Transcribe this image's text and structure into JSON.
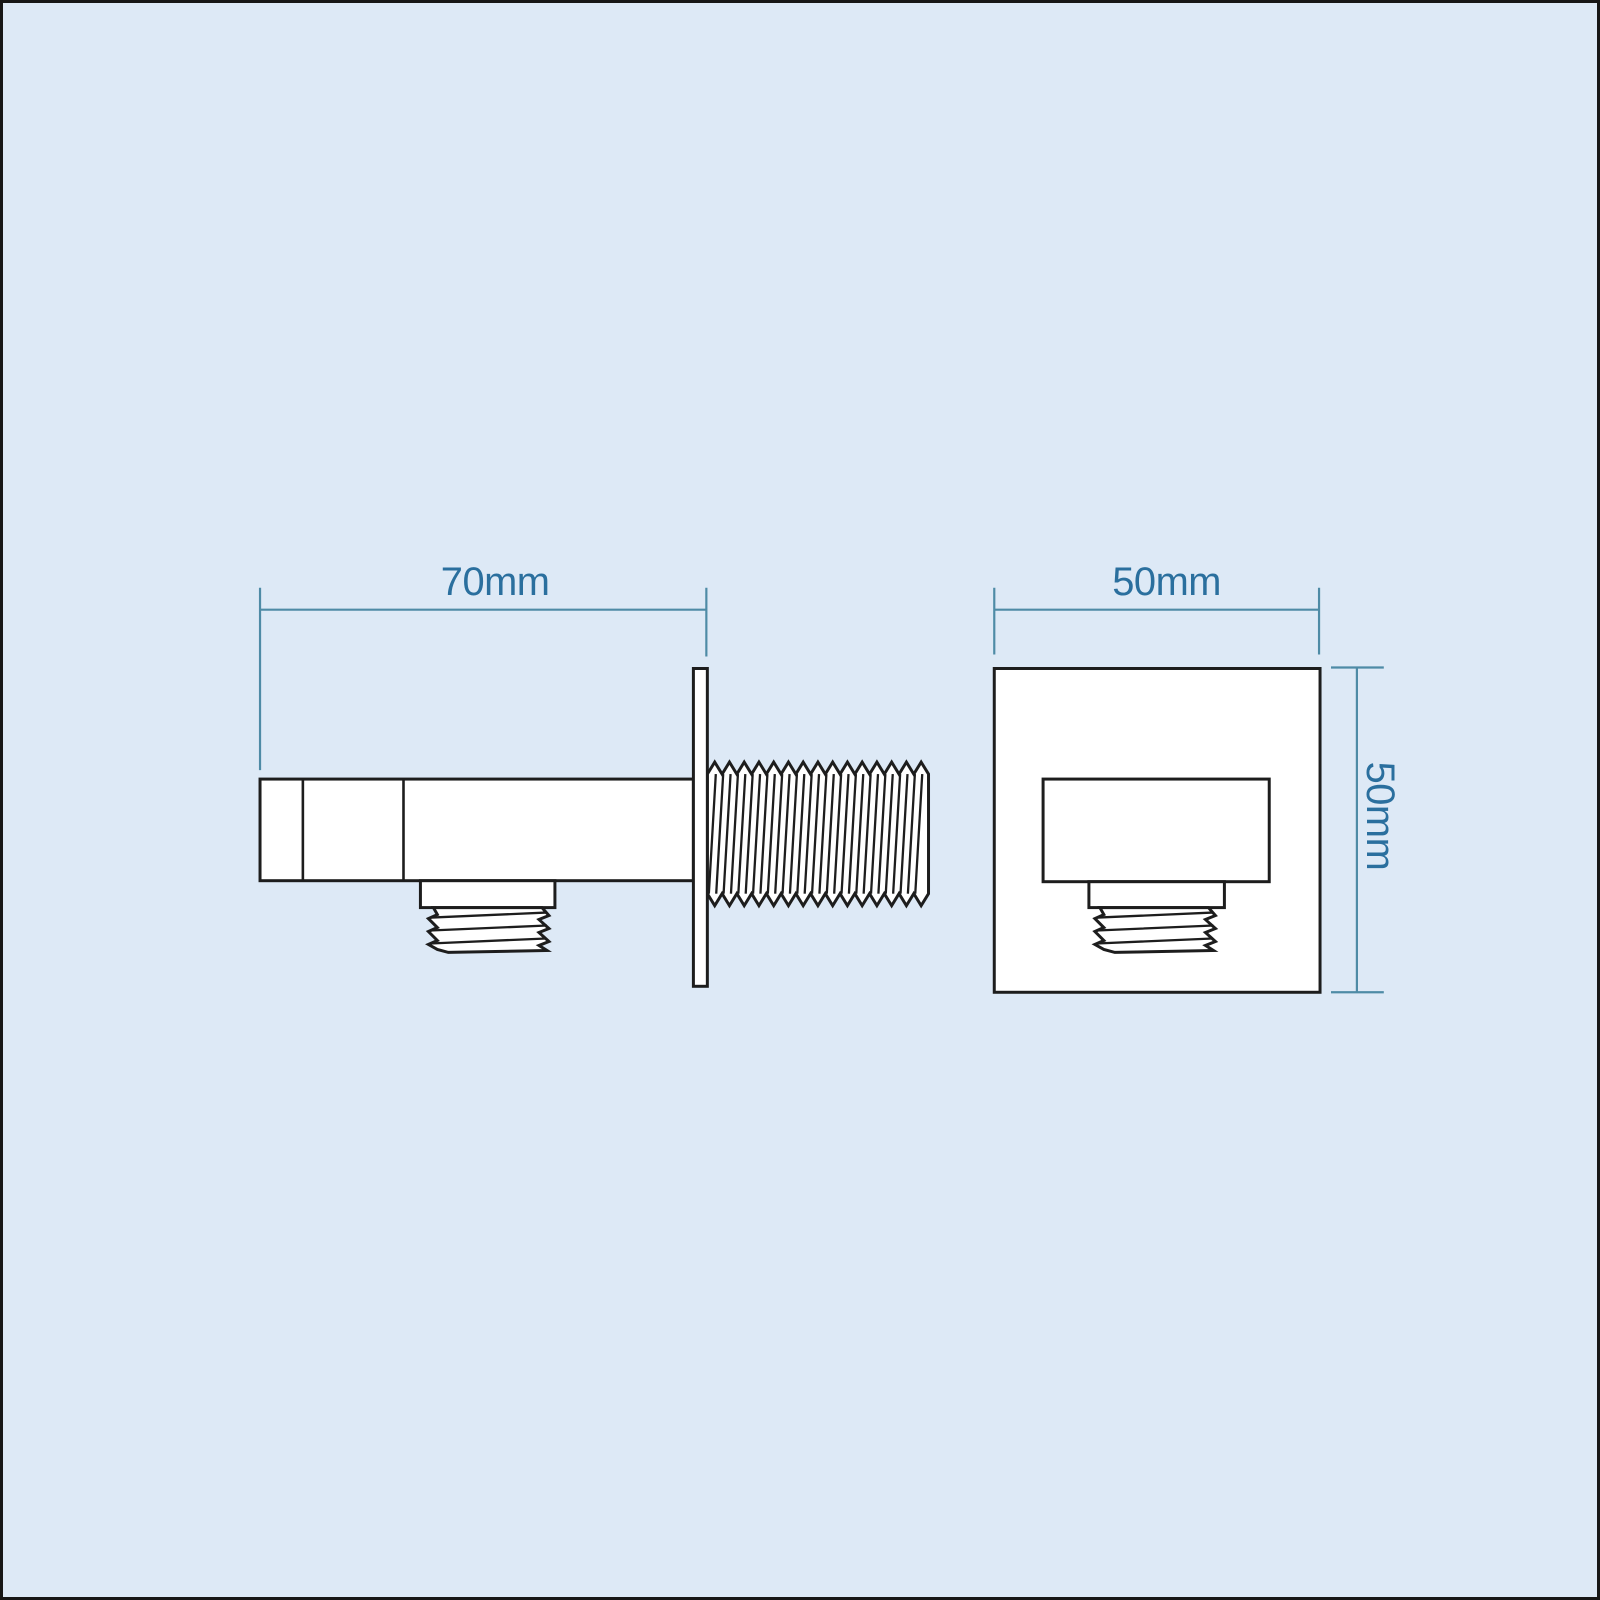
{
  "colors": {
    "background": "#dde9f6",
    "border": "#161616",
    "part_outline": "#1d1d1d",
    "part_fill": "#ffffff",
    "dimension_line": "#4e8ba6",
    "dimension_text": "#2a6f9e"
  },
  "dimensions": {
    "side_width": "70mm",
    "front_width": "50mm",
    "front_height": "50mm"
  }
}
